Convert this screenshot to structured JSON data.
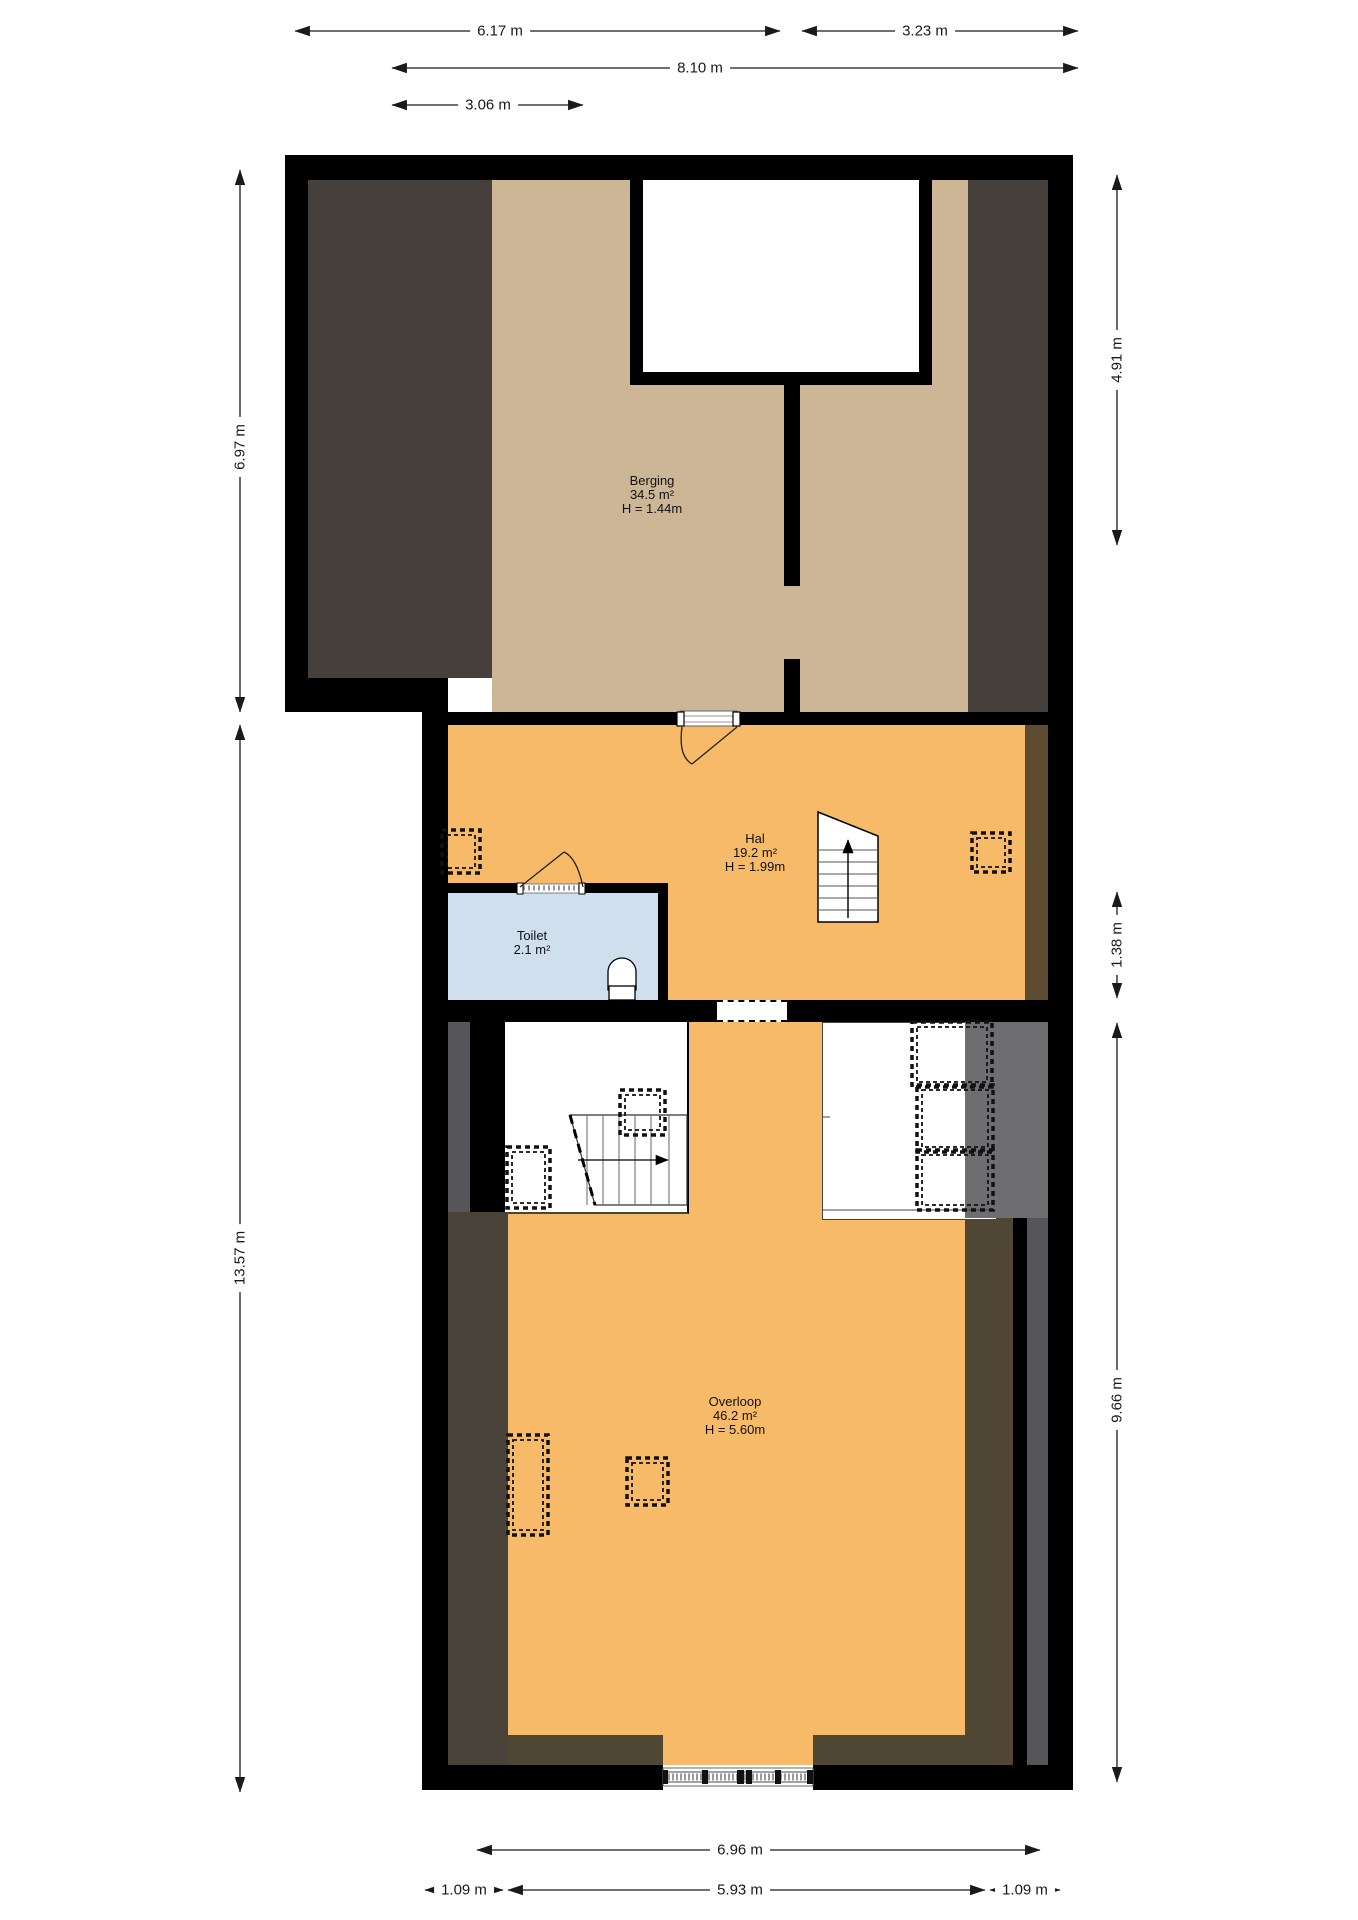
{
  "plan": {
    "title": "Floor plan - attic storey",
    "rooms": {
      "berging": {
        "name": "Berging",
        "area": "34.5 m²",
        "height": "H = 1.44m"
      },
      "hal": {
        "name": "Hal",
        "area": "19.2 m²",
        "height": "H = 1.99m"
      },
      "toilet": {
        "name": "Toilet",
        "area": "2.1 m²"
      },
      "overloop": {
        "name": "Overloop",
        "area": "46.2 m²",
        "height": "H = 5.60m"
      }
    },
    "dimensions": {
      "top": [
        "6.17 m",
        "3.23 m",
        "8.10 m",
        "3.06 m"
      ],
      "left": [
        "6.97 m",
        "13.57 m"
      ],
      "right": [
        "4.91 m",
        "1.38 m",
        "9.66 m"
      ],
      "bottom": [
        "6.96 m",
        "1.09 m",
        "5.93 m",
        "1.09 m"
      ]
    },
    "colors": {
      "wall": "#000000",
      "floor_accent_orange": "#f7ba68",
      "floor_beige": "#cdb696",
      "toilet_blue": "#cfdfee",
      "attic_dark_brown": "#45403b",
      "hal_side_brown": "#5d4b32",
      "side_gray": "#55555a",
      "side_olive": "#4a4339",
      "closet_shade_gray": "#6e6e70"
    }
  }
}
